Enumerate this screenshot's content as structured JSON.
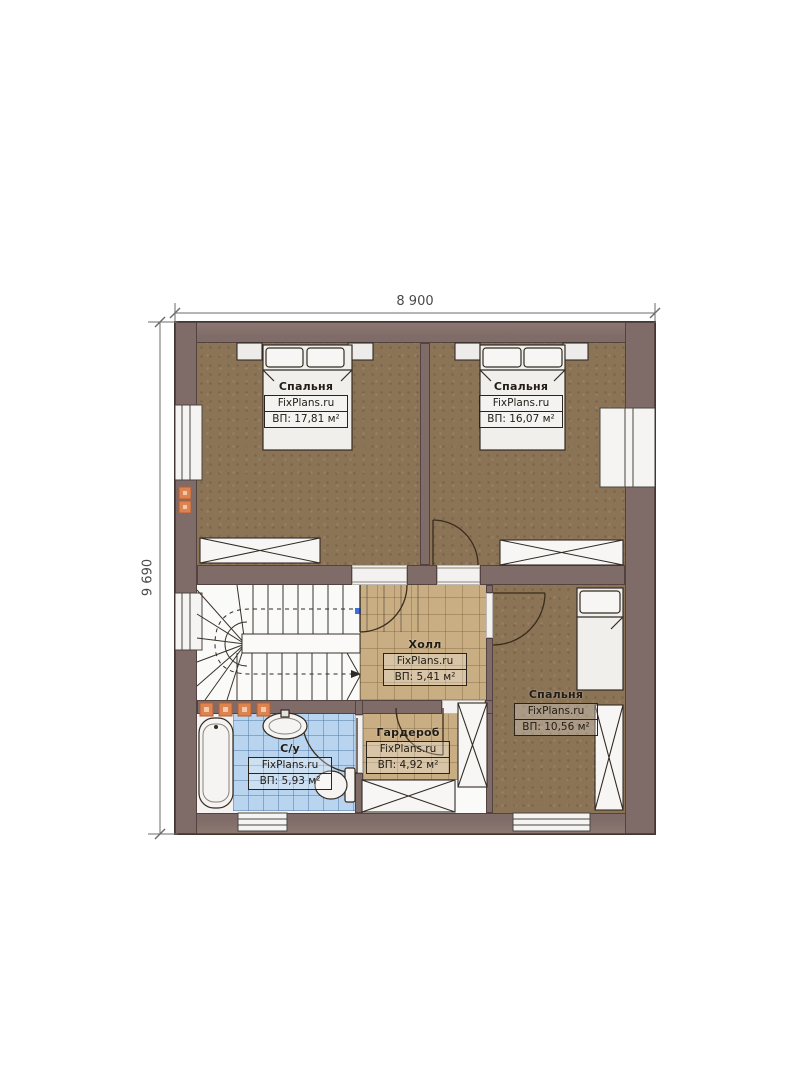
{
  "dimensions": {
    "top": "8 900",
    "left": "9 690"
  },
  "rooms": {
    "bedroom_top_left": {
      "name": "Спальня",
      "brand": "FixPlans.ru",
      "area": "ВП: 17,81 м²"
    },
    "bedroom_top_right": {
      "name": "Спальня",
      "brand": "FixPlans.ru",
      "area": "ВП: 16,07 м²"
    },
    "hall": {
      "name": "Холл",
      "brand": "FixPlans.ru",
      "area": "ВП: 5,41 м²"
    },
    "bedroom_bottom": {
      "name": "Спальня",
      "brand": "FixPlans.ru",
      "area": "ВП: 10,56 м²"
    },
    "wardrobe": {
      "name": "Гардероб",
      "brand": "FixPlans.ru",
      "area": "ВП: 4,92 м²"
    },
    "bathroom": {
      "name": "С/у",
      "brand": "FixPlans.ru",
      "area": "ВП: 5,93 м²"
    }
  },
  "colors": {
    "wall": "#7f6b67",
    "floor_bedroom": "#8b7356",
    "floor_tile": "#c9ae84",
    "floor_bath": "#b9d4ee",
    "accent_orange": "#dd8350",
    "line": "#2f2a25",
    "marker_blue": "#3f6fd8"
  }
}
